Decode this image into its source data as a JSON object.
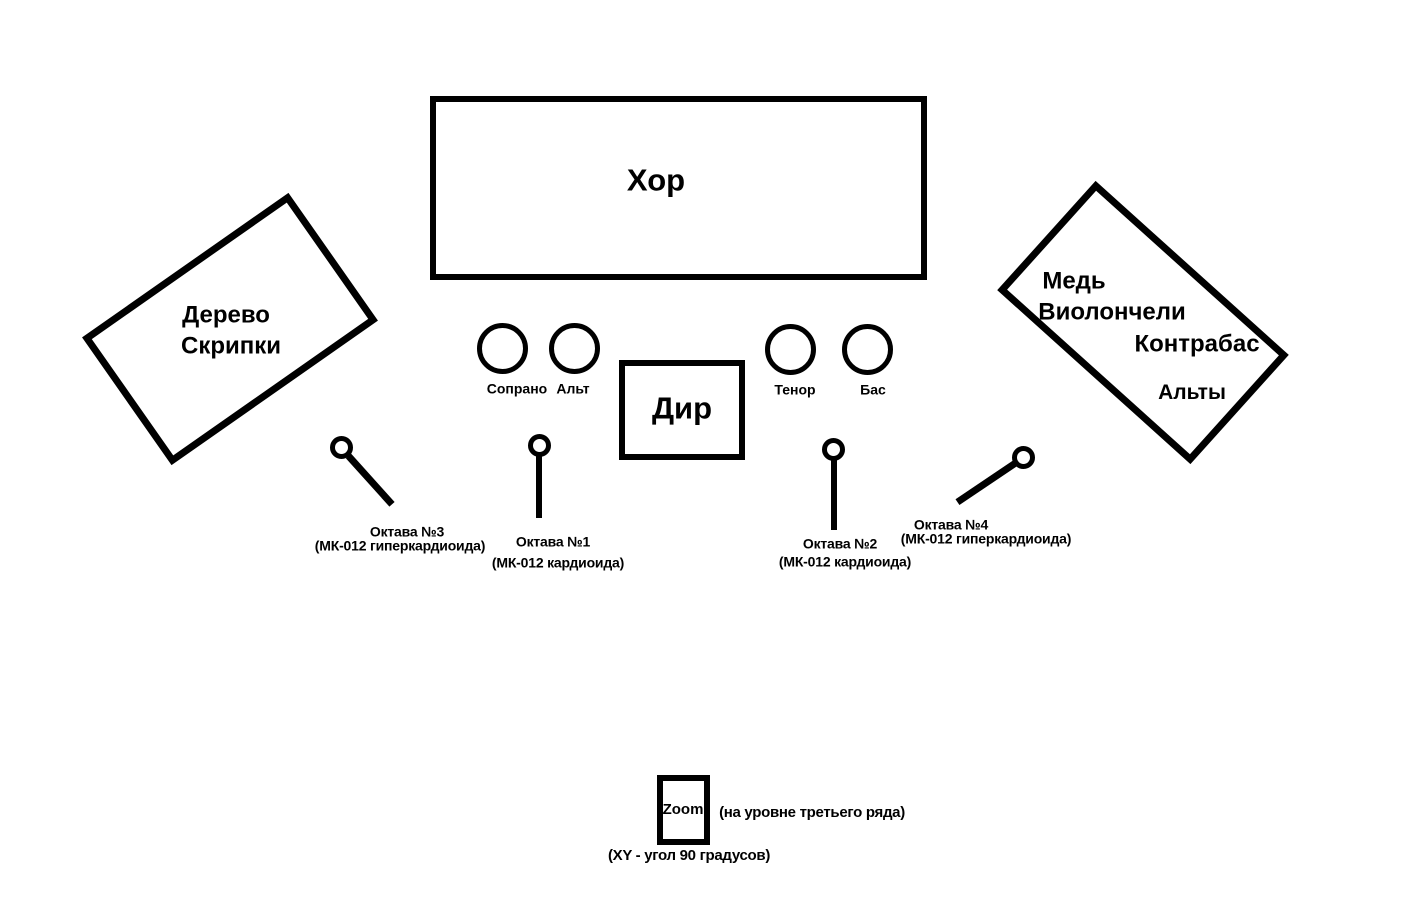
{
  "colors": {
    "ink": "#000000",
    "background": "#ffffff"
  },
  "stage": {
    "choir": "Хор",
    "conductor": "Дир",
    "left_group": {
      "lines": [
        "Дерево",
        "Скрипки"
      ]
    },
    "right_group": {
      "lines": [
        "Медь",
        "Виолончели",
        "Контрабас",
        "Альты"
      ]
    },
    "voice_sections": [
      {
        "label": "Сопрано"
      },
      {
        "label": "Альт"
      },
      {
        "label": "Тенор"
      },
      {
        "label": "Бас"
      }
    ]
  },
  "microphones": [
    {
      "name": "Октава №1",
      "spec": "(МК-012 кардиоида)"
    },
    {
      "name": "Октава №2",
      "spec": "(МК-012 кардиоида)"
    },
    {
      "name": "Октава №3",
      "spec": "(МК-012 гиперкардиоида)"
    },
    {
      "name": "Октава №4",
      "spec": "(МК-012 гиперкардиоида)"
    }
  ],
  "recorder": {
    "label": "Zoom",
    "note_level": "(на уровне третьего ряда)",
    "note_angle": "(XY - угол 90 градусов)"
  }
}
